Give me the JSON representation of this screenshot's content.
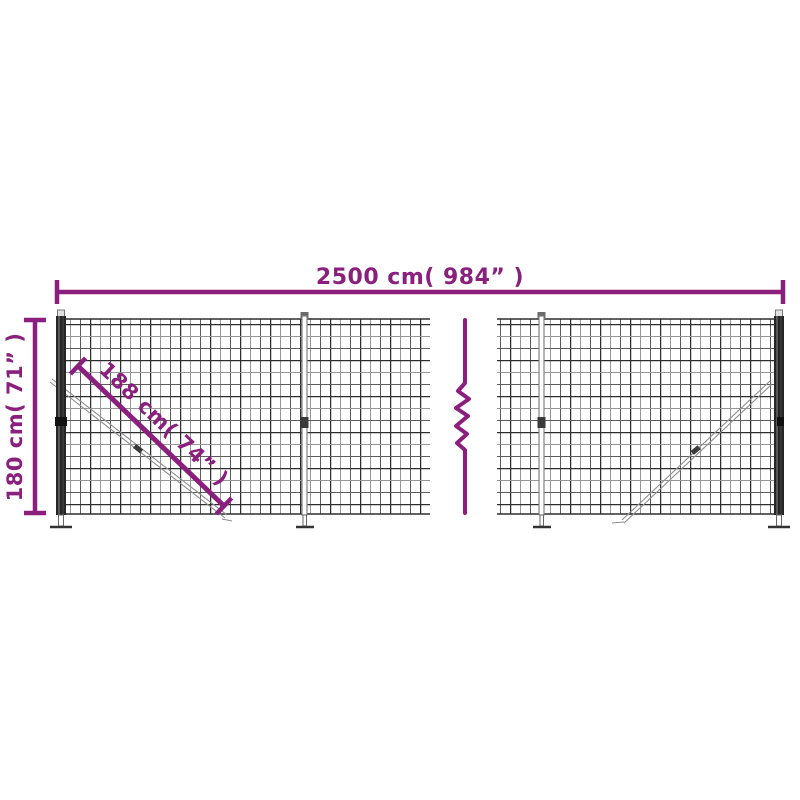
{
  "diagram": {
    "name": "wire-mesh-fence-dimension-diagram",
    "labels": {
      "total_width": "2500 cm( 984” )",
      "height": "180 cm( 71” )",
      "brace_length": "188 cm( 74” )"
    },
    "dimensions": {
      "total_width_cm": 2500,
      "total_width_in": 984,
      "height_cm": 180,
      "height_in": 71,
      "brace_length_cm": 188,
      "brace_length_in": 74
    },
    "colors": {
      "dimension_accent": "#8B1F7E",
      "mesh_dark": "#2E2E2E",
      "mesh_medium": "#5C5C5C",
      "mesh_light": "#969696",
      "post_dark": "#262626",
      "brace_gray": "#8F8F8F",
      "background": "#FFFFFF"
    }
  }
}
